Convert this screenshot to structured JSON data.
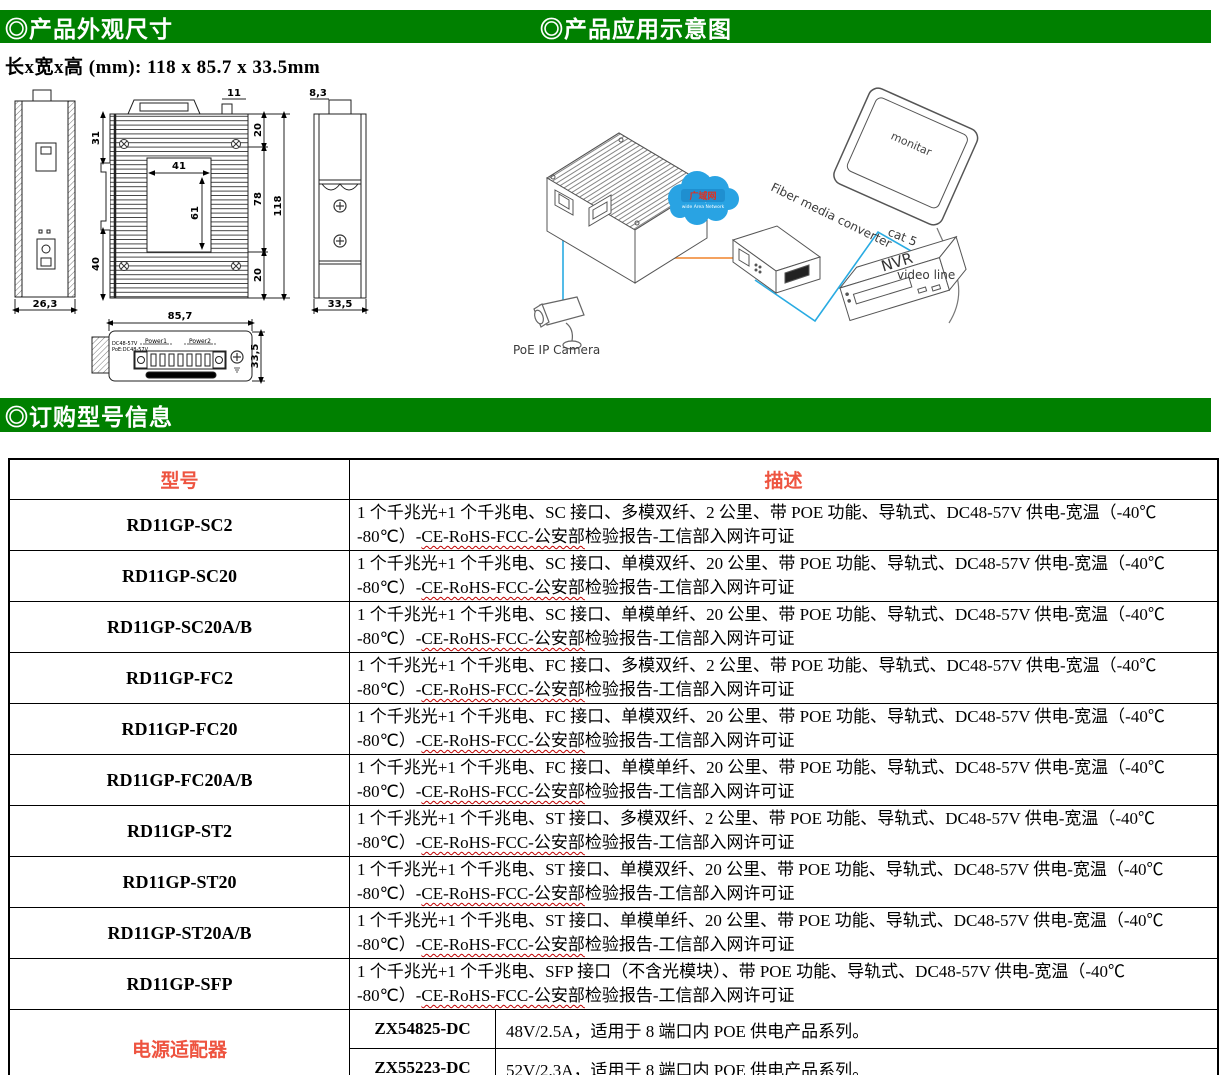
{
  "headers": {
    "h1": "◎产品外观尺寸",
    "h2": "◎产品应用示意图",
    "h3": "◎订购型号信息",
    "dims": "长x宽x高 (mm): 118 x 85.7 x 33.5mm"
  },
  "colors": {
    "green": "#008000",
    "accent_red": "#ee5440",
    "line_blue": "#29abe2",
    "line_orange": "#f0832a",
    "cloud_blue": "#29a3e3"
  },
  "drawings": {
    "front": {
      "width": "26,3"
    },
    "top": {
      "d31": "31",
      "d41": "41",
      "d61": "61",
      "d40": "40",
      "d11": "11",
      "d20t": "20",
      "d78": "78",
      "d118": "118",
      "d20b": "20"
    },
    "side": {
      "d83": "8,3",
      "d335": "33,5"
    },
    "bottom": {
      "d857": "85,7",
      "d335": "33,5",
      "line1": "DC48-57V",
      "line2": "PoE:DC48-57V",
      "p1": "Power1",
      "p2": "Power2"
    }
  },
  "diagram": {
    "camera": "PoE IP Camera",
    "cloud": "广域网",
    "cloud_sub": "wide Area Network",
    "converter": "Fiber media converter",
    "monitor": "monitar",
    "cat5": "cat 5",
    "video": "video line",
    "nvr": "NVR"
  },
  "table": {
    "col_model": "型号",
    "col_desc": "描述",
    "rows": [
      {
        "model": "RD11GP-SC2",
        "line1": "1 个千兆光+1 个千兆电、SC 接口、多模双纤、2 公里、带 POE 功能、导轨式、DC48-57V 供电-宽温（-40℃",
        "line2_pre": "-80℃）-",
        "line2_wavy": "CE-RoHS-FCC-公安部",
        "line2_post": "检验报告-工信部入网许可证"
      },
      {
        "model": "RD11GP-SC20",
        "line1": "1 个千兆光+1 个千兆电、SC 接口、单模双纤、20 公里、带 POE 功能、导轨式、DC48-57V 供电-宽温（-40℃",
        "line2_pre": "-80℃）-",
        "line2_wavy": "CE-RoHS-FCC-公安部",
        "line2_post": "检验报告-工信部入网许可证"
      },
      {
        "model": "RD11GP-SC20A/B",
        "line1": "1 个千兆光+1 个千兆电、SC 接口、单模单纤、20 公里、带 POE 功能、导轨式、DC48-57V 供电-宽温（-40℃",
        "line2_pre": "-80℃）-",
        "line2_wavy": "CE-RoHS-FCC-公安部",
        "line2_post": "检验报告-工信部入网许可证"
      },
      {
        "model": "RD11GP-FC2",
        "line1": "1 个千兆光+1 个千兆电、FC 接口、多模双纤、2 公里、带 POE 功能、导轨式、DC48-57V 供电-宽温（-40℃",
        "line2_pre": "-80℃）-",
        "line2_wavy": "CE-RoHS-FCC-公安部",
        "line2_post": "检验报告-工信部入网许可证"
      },
      {
        "model": "RD11GP-FC20",
        "line1": "1 个千兆光+1 个千兆电、FC 接口、单模双纤、20 公里、带 POE 功能、导轨式、DC48-57V 供电-宽温（-40℃",
        "line2_pre": "-80℃）-",
        "line2_wavy": "CE-RoHS-FCC-公安部",
        "line2_post": "检验报告-工信部入网许可证"
      },
      {
        "model": "RD11GP-FC20A/B",
        "line1": "1 个千兆光+1 个千兆电、FC 接口、单模单纤、20 公里、带 POE 功能、导轨式、DC48-57V 供电-宽温（-40℃",
        "line2_pre": "-80℃）-",
        "line2_wavy": "CE-RoHS-FCC-公安部",
        "line2_post": "检验报告-工信部入网许可证"
      },
      {
        "model": "RD11GP-ST2",
        "line1": "1 个千兆光+1 个千兆电、ST 接口、多模双纤、2 公里、带 POE 功能、导轨式、DC48-57V 供电-宽温（-40℃",
        "line2_pre": "-80℃）-",
        "line2_wavy": "CE-RoHS-FCC-公安部",
        "line2_post": "检验报告-工信部入网许可证"
      },
      {
        "model": "RD11GP-ST20",
        "line1": "1 个千兆光+1 个千兆电、ST 接口、单模双纤、20 公里、带 POE 功能、导轨式、DC48-57V 供电-宽温（-40℃",
        "line2_pre": "-80℃）-",
        "line2_wavy": "CE-RoHS-FCC-公安部",
        "line2_post": "检验报告-工信部入网许可证"
      },
      {
        "model": "RD11GP-ST20A/B",
        "line1": "1 个千兆光+1 个千兆电、ST 接口、单模单纤、20 公里、带 POE 功能、导轨式、DC48-57V 供电-宽温（-40℃",
        "line2_pre": "-80℃）-",
        "line2_wavy": "CE-RoHS-FCC-公安部",
        "line2_post": "检验报告-工信部入网许可证"
      },
      {
        "model": "RD11GP-SFP",
        "line1": "1 个千兆光+1 个千兆电、SFP 接口（不含光模块）、带 POE 功能、导轨式、DC48-57V 供电-宽温（-40℃",
        "line2_pre": "-80℃）-",
        "line2_wavy": "CE-RoHS-FCC-公安部",
        "line2_post": "检验报告-工信部入网许可证"
      }
    ],
    "adapter": {
      "label": "电源适配器",
      "rows": [
        {
          "code": "ZX54825-DC",
          "desc": "48V/2.5A，适用于 8 端口内 POE 供电产品系列。"
        },
        {
          "code": "ZX55223-DC",
          "desc": "52V/2.3A，适用于 8 端口内 POE 供电产品系列。"
        }
      ]
    }
  }
}
